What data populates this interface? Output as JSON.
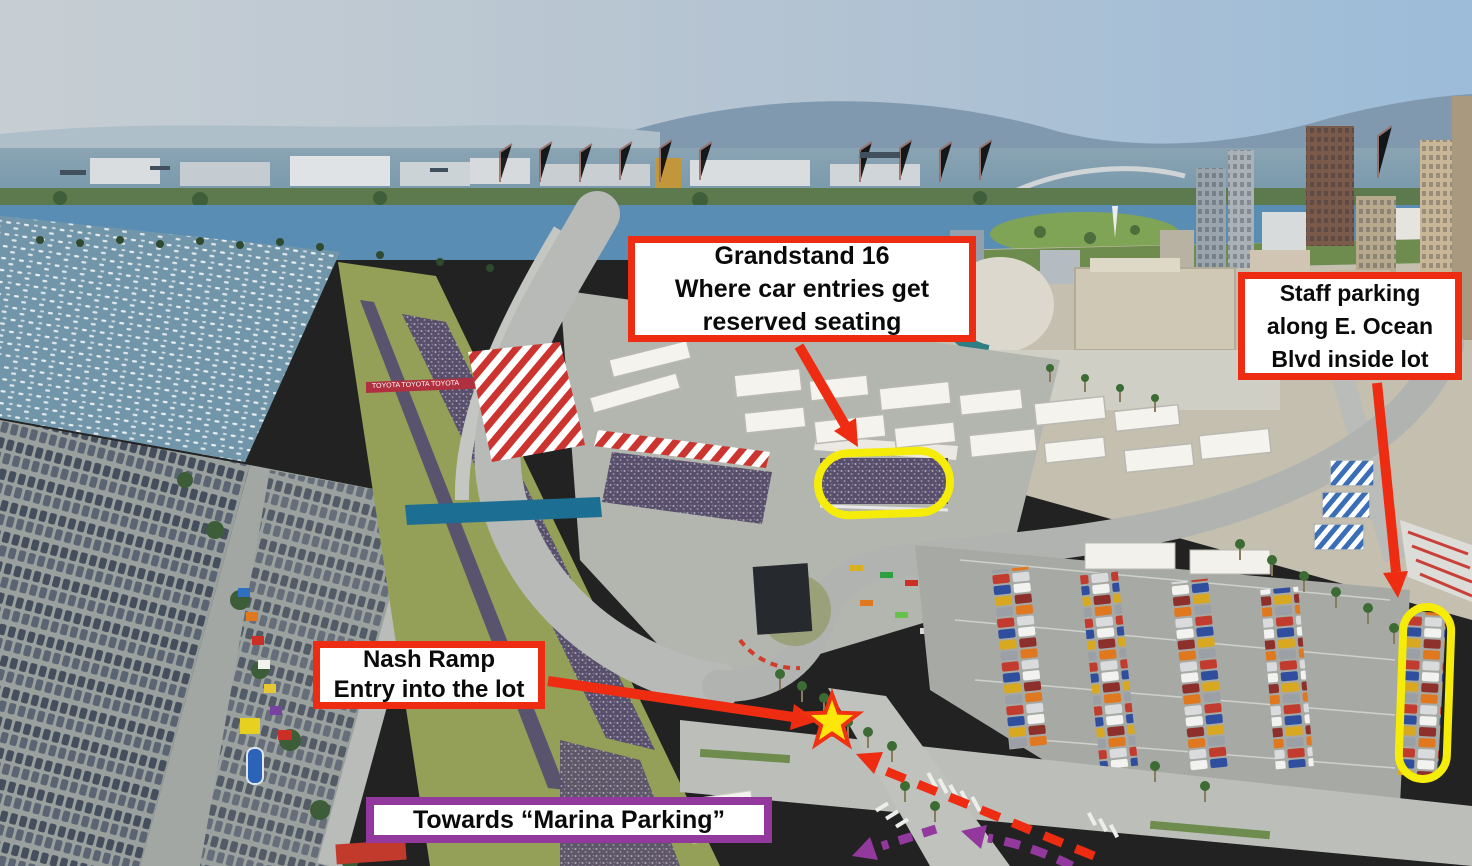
{
  "title": "Aerial wayfinding map - Grand Prix of Long Beach parking and grandstand locations",
  "colors": {
    "annotation_red": "#ee2c12",
    "annotation_purple": "#93399e",
    "highlight_yellow": "#f5ec0a",
    "star_fill": "#ffe60a",
    "star_stroke": "#f03210"
  },
  "callouts": {
    "grandstand16": {
      "lines": [
        "Grandstand 16",
        "Where car entries get",
        "reserved seating"
      ]
    },
    "staff_parking": {
      "lines": [
        "Staff parking",
        "along E. Ocean",
        "Blvd inside lot"
      ]
    },
    "nash_ramp": {
      "lines": [
        "Nash Ramp",
        "Entry into the lot"
      ]
    },
    "marina_parking": {
      "text": "Towards “Marina Parking”"
    }
  },
  "background": {
    "toyota_banner": "TOYOTA TOYOTA TOYOTA"
  }
}
